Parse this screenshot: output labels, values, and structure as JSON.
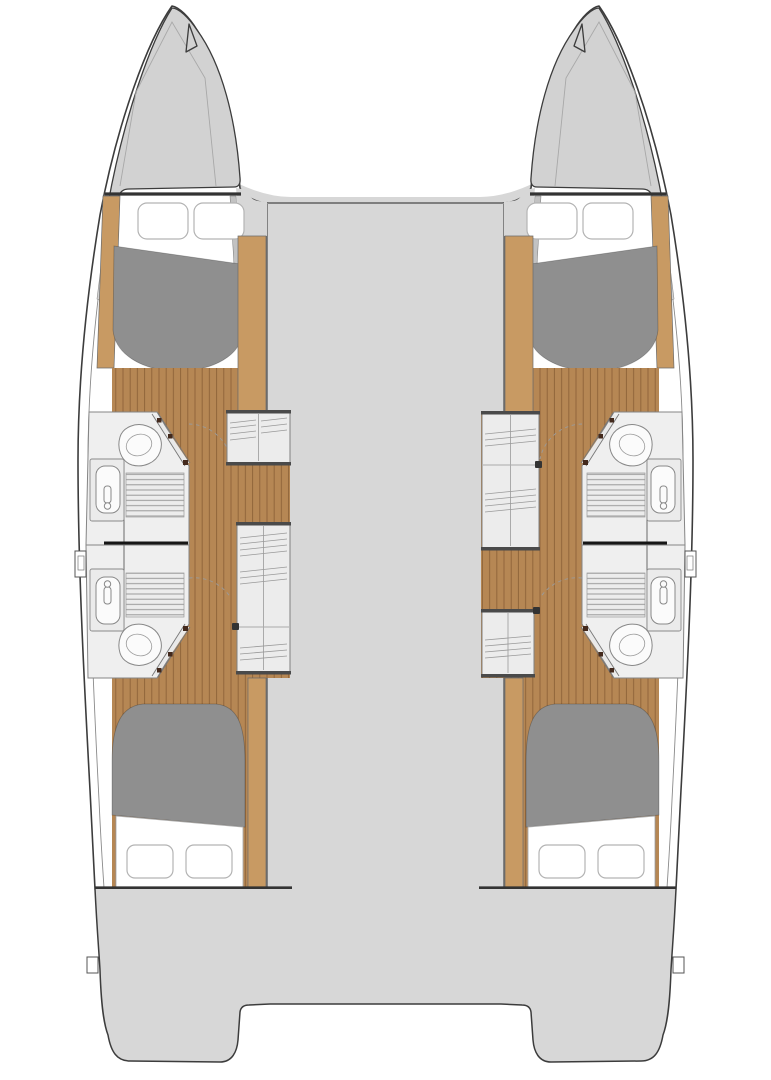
{
  "diagram": {
    "type": "boat-floor-plan",
    "subject": "catamaran-interior-layout",
    "orientation": "bow-up"
  },
  "colors": {
    "page_background": "#ffffff",
    "deck_gray": "#d7d7d7",
    "bow_gray": "#d2d2d2",
    "hull_white": "#ffffff",
    "outline_dark": "#3c3c3c",
    "outline_mid": "#8a8a8a",
    "wood_floor": "#b68754",
    "wood_plank_line": "#8d6238",
    "wood_trim": "#c89a63",
    "bed_gray": "#8f8f8f",
    "fixture_fill": "#efefef",
    "fixture_stroke": "#858585",
    "grate_line": "#9a9a9a",
    "divider_black": "#161616",
    "bulkhead_dark": "#333333",
    "hinge_dot": "#43291c",
    "pillow_stroke": "#b3b3b3"
  },
  "regions": [
    {
      "id": "port-bow",
      "kind": "bow"
    },
    {
      "id": "starboard-bow",
      "kind": "bow"
    },
    {
      "id": "trampoline-gap",
      "kind": "open-space"
    },
    {
      "id": "bridge-deck",
      "kind": "deck"
    },
    {
      "id": "cockpit",
      "kind": "aft-deck-with-twin-stern-platforms"
    },
    {
      "id": "port-forward-cabin",
      "kind": "cabin-double-berth"
    },
    {
      "id": "port-forward-head",
      "kind": "bathroom-toilet-sink-shower"
    },
    {
      "id": "port-aft-head",
      "kind": "bathroom-toilet-sink-shower"
    },
    {
      "id": "port-aft-cabin",
      "kind": "cabin-double-berth"
    },
    {
      "id": "port-companionway",
      "kind": "steps-and-lockers"
    },
    {
      "id": "starboard-forward-cabin",
      "kind": "cabin-double-berth"
    },
    {
      "id": "starboard-forward-head",
      "kind": "bathroom-toilet-sink-shower"
    },
    {
      "id": "starboard-aft-head",
      "kind": "bathroom-toilet-sink-shower"
    },
    {
      "id": "starboard-aft-cabin",
      "kind": "cabin-double-berth"
    },
    {
      "id": "starboard-companionway",
      "kind": "steps-and-lockers"
    }
  ],
  "fixtures": {
    "double_berths": 4,
    "toilets": 4,
    "sinks": 4,
    "shower_grates": 4,
    "pillows": 8,
    "companionway_locker_boxes": 4
  }
}
